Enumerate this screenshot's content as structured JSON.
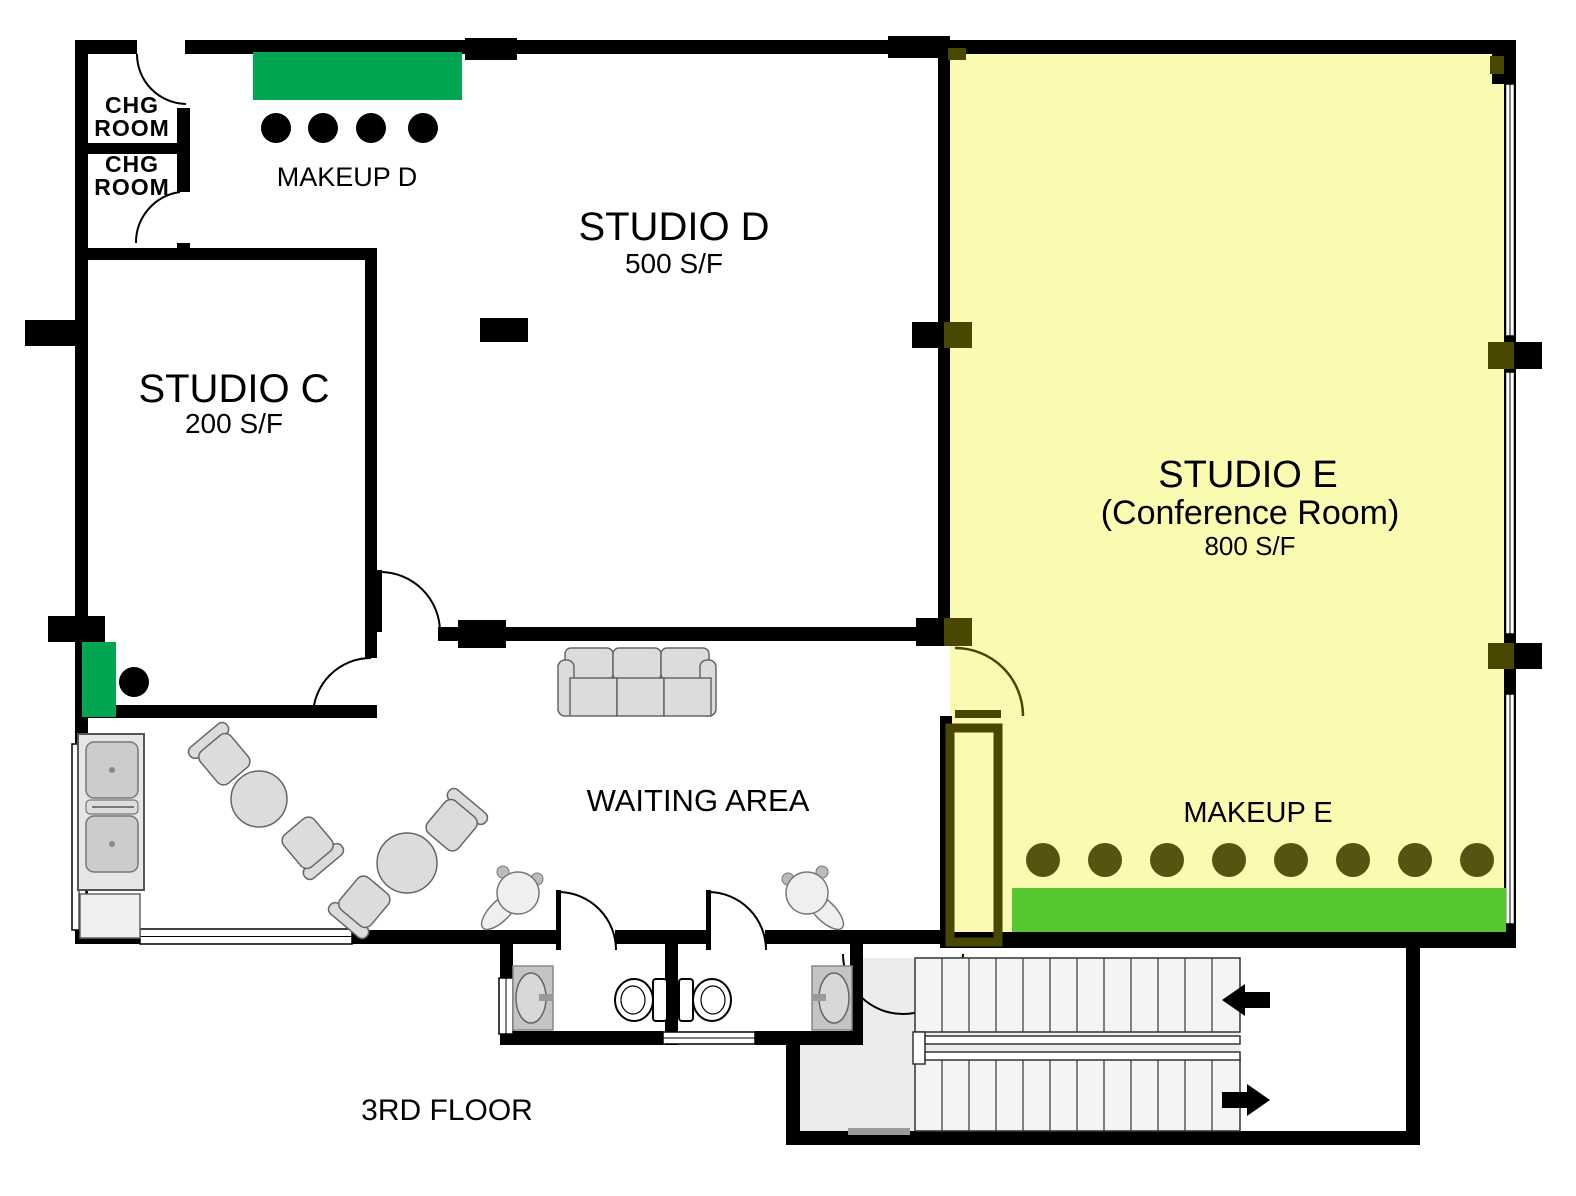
{
  "page": {
    "type": "floor-plan",
    "floor_label": "3RD FLOOR"
  },
  "rooms": {
    "studio_c": {
      "name": "STUDIO C",
      "area": "200 S/F"
    },
    "studio_d": {
      "name": "STUDIO D",
      "area": "500 S/F"
    },
    "studio_e": {
      "name": "STUDIO E",
      "subtitle": "(Conference Room)",
      "area": "800 S/F"
    },
    "waiting_area": {
      "name": "WAITING AREA"
    },
    "chg_room_1": {
      "line1": "CHG",
      "line2": "ROOM"
    },
    "chg_room_2": {
      "line1": "CHG",
      "line2": "ROOM"
    },
    "makeup_d": {
      "name": "MAKEUP D",
      "chair_count": 4
    },
    "makeup_e": {
      "name": "MAKEUP E",
      "chair_count": 8
    },
    "stairwell": {
      "up_arrow_direction": "left",
      "down_arrow_direction": "right"
    }
  },
  "colors": {
    "wall": "#000000",
    "studio_e_highlight": "#FAFAB0",
    "studio_e_accent": "#4A4800",
    "studio_e_text": "#4A4A10",
    "makeup_d_counter": "#00A651",
    "makeup_e_counter": "#55C82F",
    "stair_floor": "#ECECEC",
    "furniture": "#DCDCDC"
  }
}
